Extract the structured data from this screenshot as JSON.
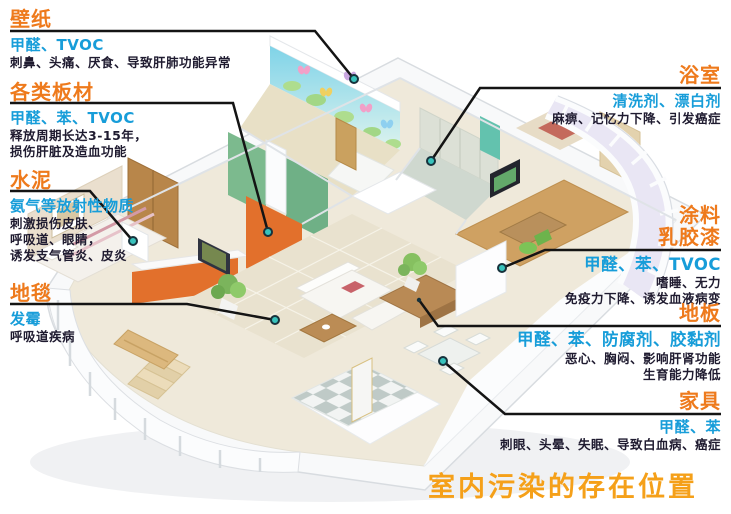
{
  "palette": {
    "title_orange": "#ee7a1c",
    "pollutant_blue": "#179dd9",
    "body_text": "#1f1b30",
    "leader_line": "#141414",
    "dot_teal": "#38c2bc",
    "footer_orange": "#f5a019",
    "accent_wall_orange": "#e2702c"
  },
  "footer": {
    "title": "室内污染的存在位置"
  },
  "callouts": [
    {
      "id": "wallpaper",
      "side": "left",
      "title": "壁纸",
      "pollutants": "甲醛、TVOC",
      "effects": [
        "刺鼻、头痛、厌食、导致肝肺功能异常"
      ]
    },
    {
      "id": "boards",
      "side": "left",
      "title": "各类板材",
      "pollutants": "甲醛、苯、TVOC",
      "effects": [
        "释放周期长达3-15年，",
        "损伤肝脏及造血功能"
      ]
    },
    {
      "id": "cement",
      "side": "left",
      "title": "水泥",
      "pollutants": "氨气等放射性物质",
      "effects": [
        "刺激损伤皮肤、",
        "呼吸道、眼睛，",
        "诱发支气管炎、皮炎"
      ]
    },
    {
      "id": "carpet",
      "side": "left",
      "title": "地毯",
      "pollutants": "发霉",
      "effects": [
        "呼吸道疾病"
      ]
    },
    {
      "id": "bathroom",
      "side": "right",
      "title": "浴室",
      "pollutants": "清洗剂、漂白剂",
      "effects": [
        "麻痹、记忆力下降、引发癌症"
      ]
    },
    {
      "id": "paint",
      "side": "right",
      "title": "涂料",
      "title2": "乳胶漆",
      "pollutants": "甲醛、苯、TVOC",
      "effects": [
        "嗜睡、无力",
        "免疫力下降、诱发血液病变"
      ]
    },
    {
      "id": "floor",
      "side": "right",
      "title": "地板",
      "pollutants": "甲醛、苯、防腐剂、胶黏剂",
      "effects": [
        "恶心、胸闷、影响肝肾功能",
        "生育能力降低"
      ]
    },
    {
      "id": "furniture",
      "side": "right",
      "title": "家具",
      "pollutants": "甲醛、苯",
      "effects": [
        "刺眼、头晕、失眠、导致白血病、癌症"
      ]
    }
  ]
}
